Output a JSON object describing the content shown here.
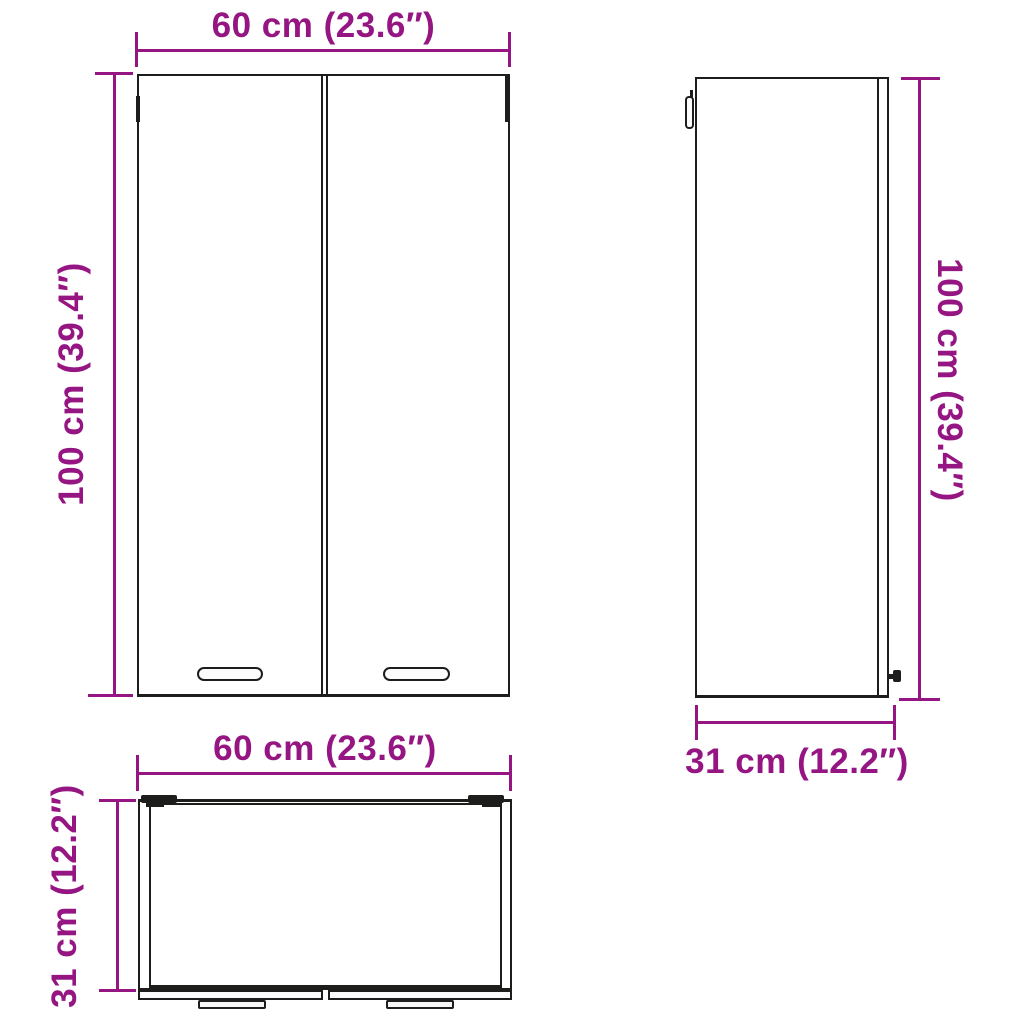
{
  "diagram": {
    "title": "Wall cabinet dimension diagram",
    "views": [
      "front-view",
      "side-view",
      "top-view"
    ]
  },
  "colors": {
    "accent": "#951682",
    "outline": "#1d1d1b",
    "background": "#ffffff"
  },
  "dimensions": {
    "front_width": {
      "label": "60 cm (23.6″)",
      "value_cm": 60,
      "value_in": 23.6
    },
    "front_height": {
      "label": "100 cm (39.4″)",
      "value_cm": 100,
      "value_in": 39.4
    },
    "side_height": {
      "label": "100 cm (39.4″)",
      "value_cm": 100,
      "value_in": 39.4
    },
    "side_depth": {
      "label": "31 cm (12.2″)",
      "value_cm": 31,
      "value_in": 12.2
    },
    "top_width": {
      "label": "60 cm (23.6″)",
      "value_cm": 60,
      "value_in": 23.6
    },
    "top_depth": {
      "label": "31 cm (12.2″)",
      "value_cm": 31,
      "value_in": 12.2
    }
  }
}
